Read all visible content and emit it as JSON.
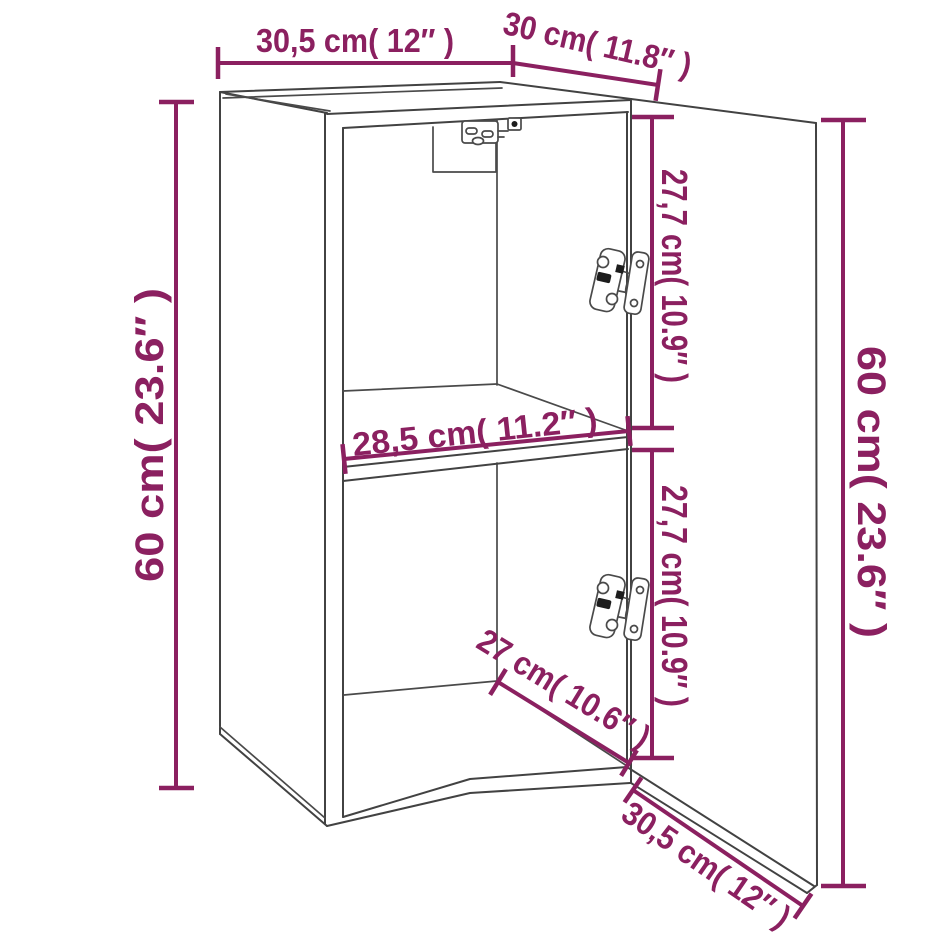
{
  "diagram": {
    "type": "product-dimension-drawing",
    "subject": "Wall-mounted cabinet with one shelf and open hinged door",
    "colors": {
      "dimension_accent": "#8b2060",
      "outline": "#424242",
      "background": "#ffffff"
    },
    "labels": {
      "top_width": "30,5 cm( 12″ )",
      "top_depth": "30 cm( 11.8″ )",
      "left_height": "60 cm( 23.6″ )",
      "upper_compartment_height": "27,7 cm( 10.9″ )",
      "lower_compartment_height": "27,7 cm( 10.9″ )",
      "door_height": "60 cm( 23.6″ )",
      "shelf_width": "28,5 cm( 11.2″ )",
      "interior_depth": "27 cm( 10.6″ )",
      "door_width": "30,5 cm( 12″ )"
    },
    "measurements": [
      {
        "id": "top_width",
        "cm": "30,5",
        "inch": "12"
      },
      {
        "id": "top_depth",
        "cm": "30",
        "inch": "11.8"
      },
      {
        "id": "left_height",
        "cm": "60",
        "inch": "23.6"
      },
      {
        "id": "upper_compartment_height",
        "cm": "27,7",
        "inch": "10.9"
      },
      {
        "id": "lower_compartment_height",
        "cm": "27,7",
        "inch": "10.9"
      },
      {
        "id": "door_height",
        "cm": "60",
        "inch": "23.6"
      },
      {
        "id": "shelf_width",
        "cm": "28,5",
        "inch": "11.2"
      },
      {
        "id": "interior_depth",
        "cm": "27",
        "inch": "10.6"
      },
      {
        "id": "door_width",
        "cm": "30,5",
        "inch": "12"
      }
    ]
  }
}
